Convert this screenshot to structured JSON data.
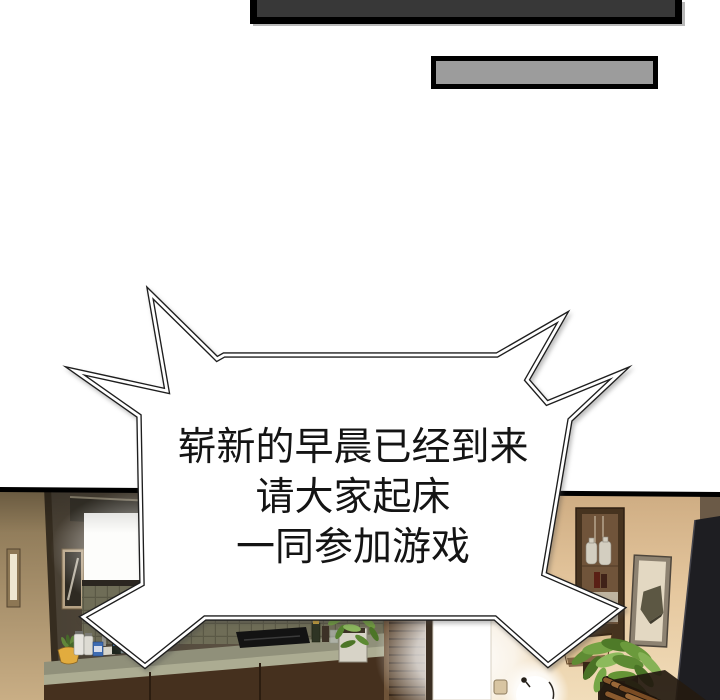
{
  "page_type": "comic-panel-page",
  "speech_bubble": {
    "shape": "spiky-burst",
    "fill": "#ffffff",
    "outline_color": "#1e1e1e",
    "text_color": "#141414",
    "lines": [
      "崭新的早晨已经到来",
      "请大家起床",
      "一同参加游戏"
    ]
  },
  "top_panels": {
    "dark_bar": {
      "fill": "#383838",
      "border_color": "#000000"
    },
    "gray_bar": {
      "fill": "#9c9c9c",
      "border_color": "#000000"
    }
  },
  "photo_panel": {
    "description_colors": {
      "panel_border": "#000000",
      "left_wall": "#c9ae85",
      "kitchen_wall": "#584e40",
      "right_wall": "#ecd2ab",
      "backsplash_tile": "#6f6d57",
      "counter_top": "#90907a",
      "cabinet_wood": "#45301e",
      "window_light": "#ffffff",
      "doorway_light": "#ffffff",
      "plant_green": "#6f9a3f",
      "lamp_shade": "#ddbf92",
      "tv_panel": "#1e1e22",
      "pot_yellow": "#e2ac3e",
      "pole_wood": "#8a5a2e"
    }
  }
}
